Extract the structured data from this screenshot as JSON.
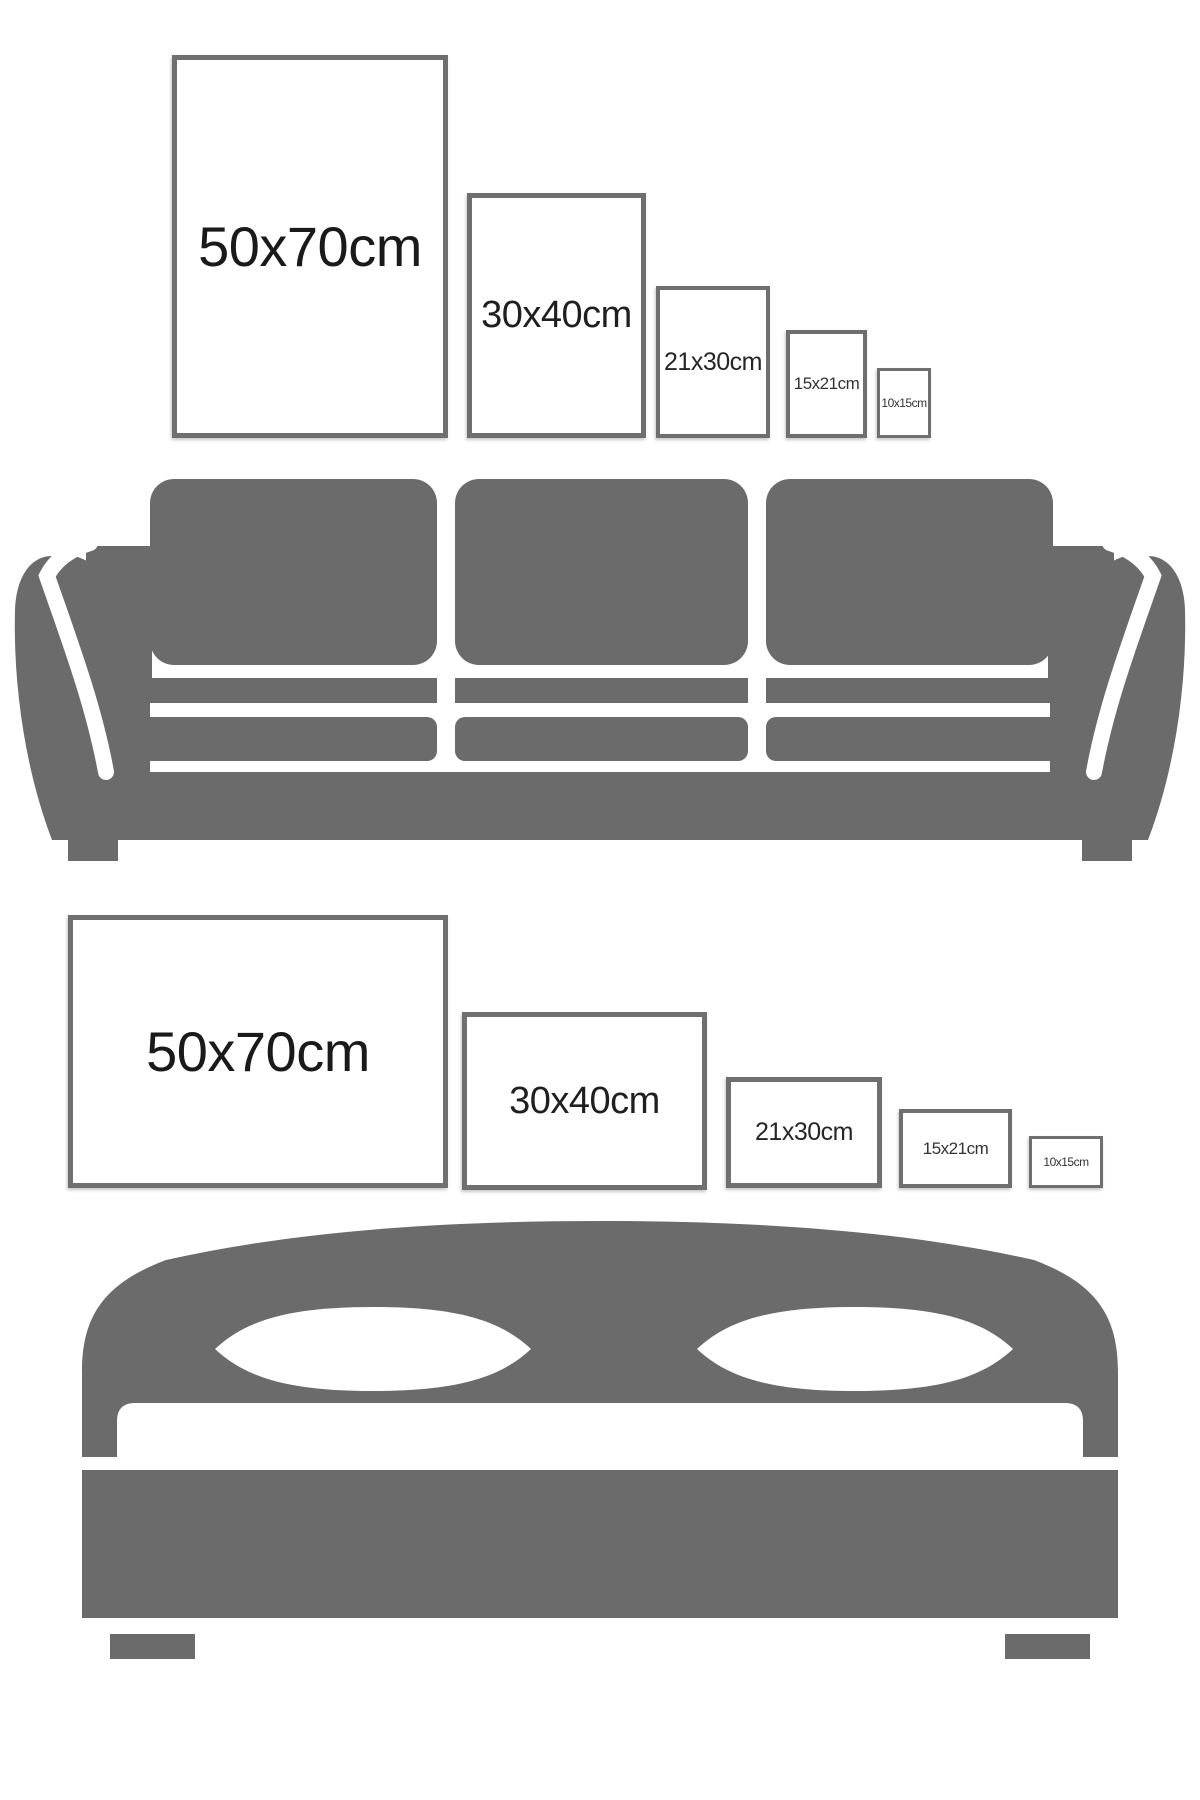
{
  "title": "Poster frame size guide",
  "colors": {
    "background": "#ffffff",
    "furniture_gray": "#6b6b6b",
    "frame_border_gray": "#6f6f6f",
    "label_dark": "#1a1a1a"
  },
  "scenes": [
    {
      "name": "sofa-scene",
      "furniture": "sofa",
      "orientation": "portrait",
      "frames": [
        {
          "label": "50x70cm"
        },
        {
          "label": "30x40cm"
        },
        {
          "label": "21x30cm"
        },
        {
          "label": "15x21cm"
        },
        {
          "label": "10x15cm"
        }
      ]
    },
    {
      "name": "bed-scene",
      "furniture": "bed",
      "orientation": "landscape",
      "frames": [
        {
          "label": "50x70cm"
        },
        {
          "label": "30x40cm"
        },
        {
          "label": "21x30cm"
        },
        {
          "label": "15x21cm"
        },
        {
          "label": "10x15cm"
        }
      ]
    }
  ]
}
